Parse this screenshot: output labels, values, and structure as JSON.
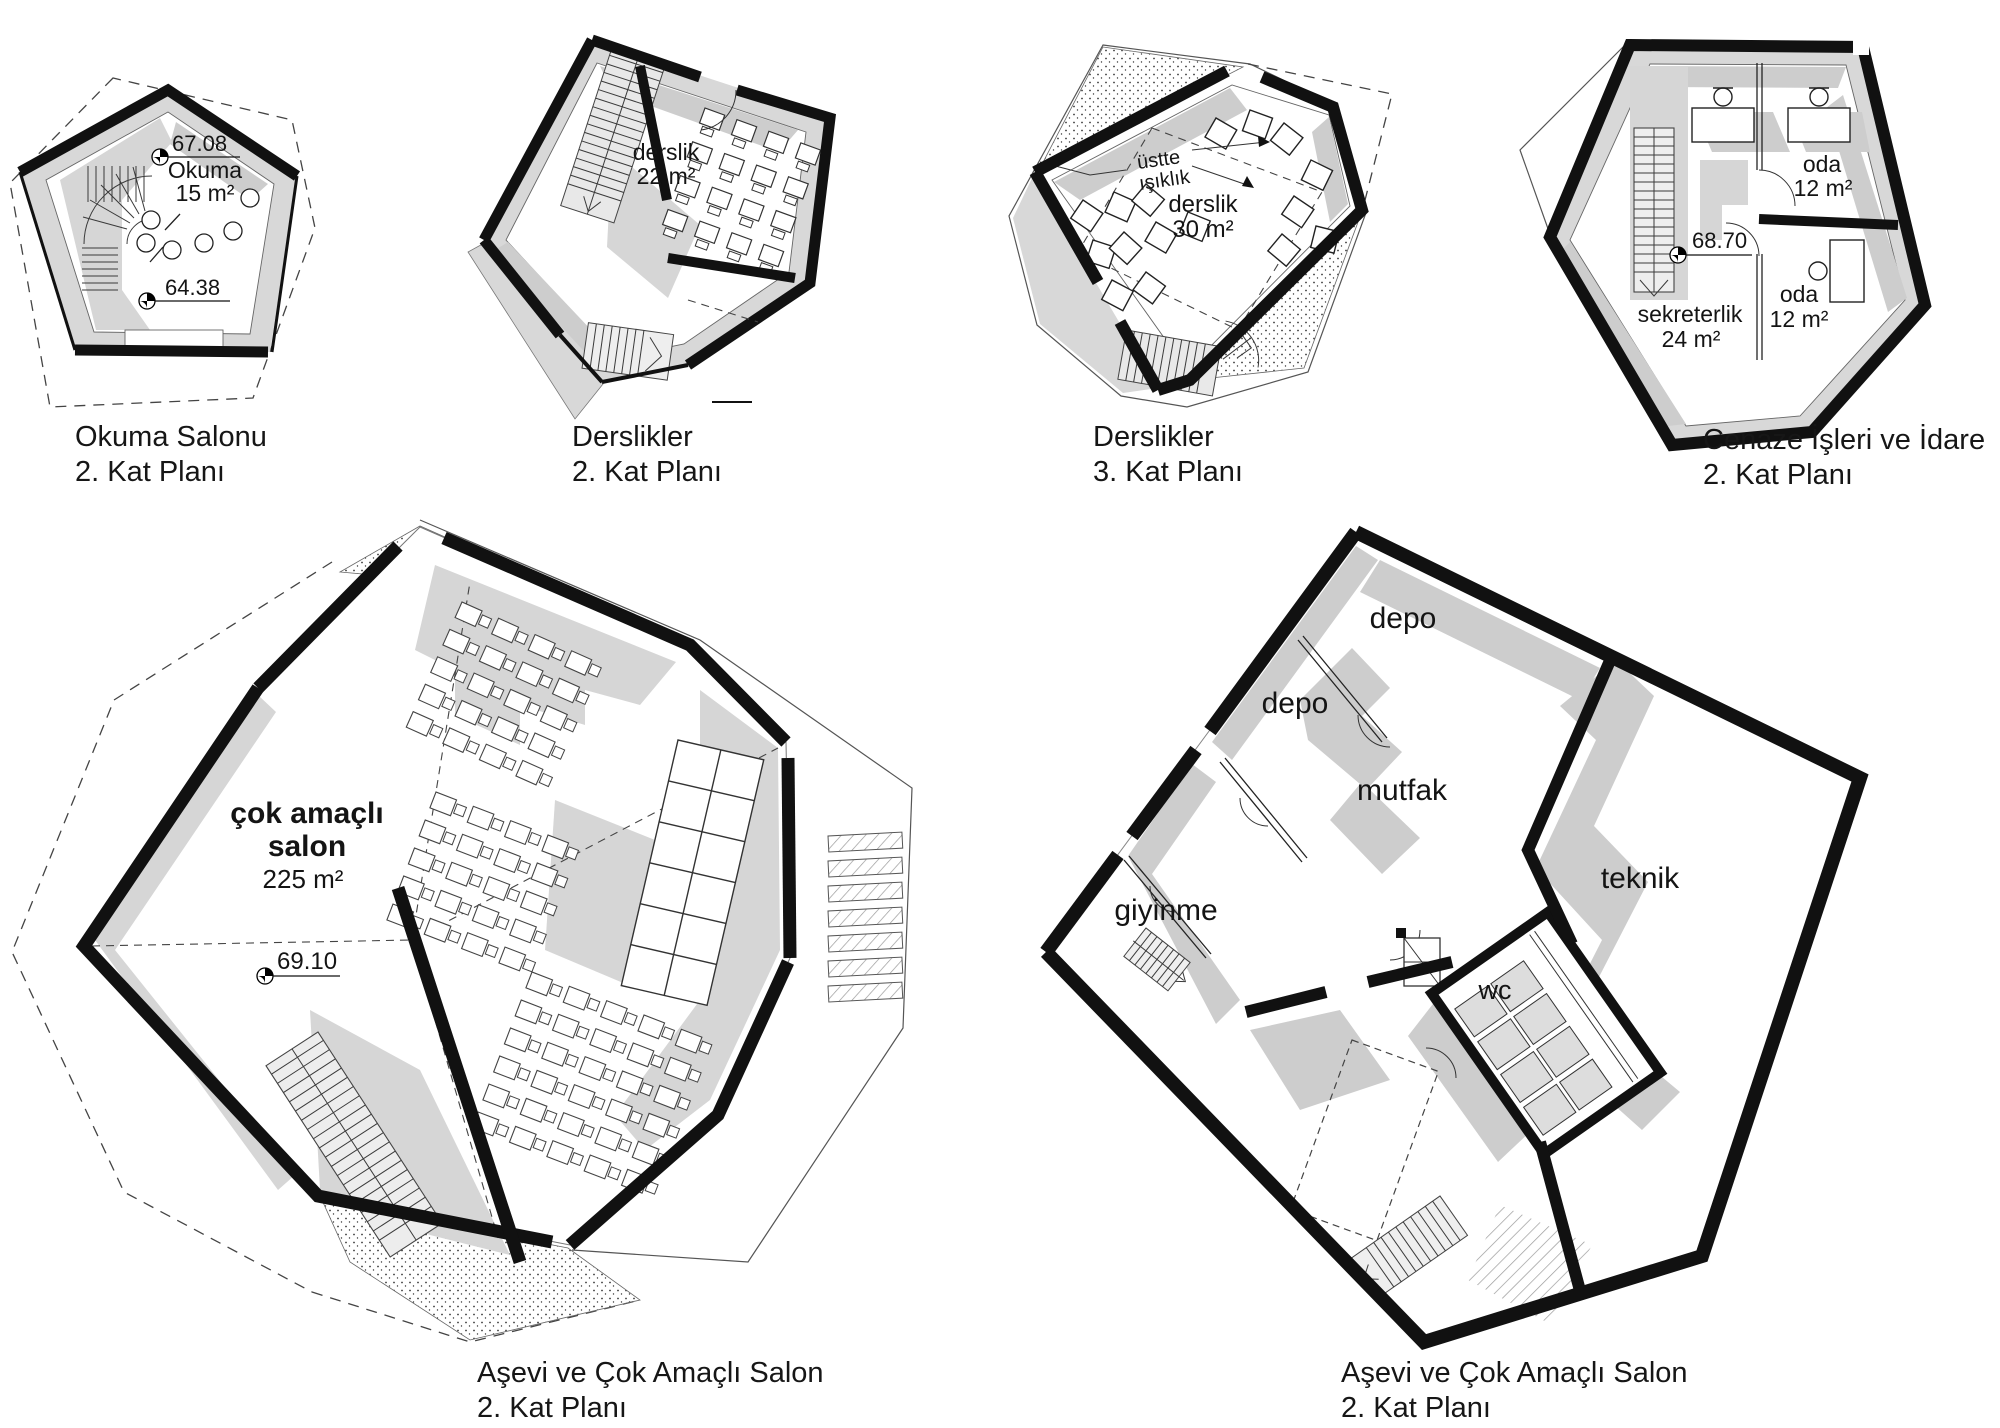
{
  "sheet": {
    "background": "#ffffff",
    "ink": "#111111",
    "poche_gray": "#d8d8d8",
    "shadow_gray": "#cdcdcd"
  },
  "plans": {
    "okuma": {
      "caption": [
        "Okuma Salonu",
        "2. Kat Planı"
      ],
      "labels": {
        "level_upper": "67.08",
        "room_name": "Okuma",
        "room_area": "15 m²",
        "level_lower": "64.38"
      }
    },
    "derslik2": {
      "caption": [
        "Derslikler",
        "2. Kat Planı"
      ],
      "labels": {
        "room_name": "derslik",
        "room_area": "22 m²"
      }
    },
    "derslik3": {
      "caption": [
        "Derslikler",
        "3. Kat Planı"
      ],
      "labels": {
        "skylight_1": "üstte",
        "skylight_2": "ışıklık",
        "room_name": "derslik",
        "room_area": "30 m²"
      }
    },
    "cenaze": {
      "caption": [
        "Cenaze İşleri ve İdare",
        "2. Kat Planı"
      ],
      "labels": {
        "level": "68.70",
        "office_top": "oda",
        "office_top_area": "12 m²",
        "secretary": "sekreterlik",
        "secretary_area": "24 m²",
        "office_bottom": "oda",
        "office_bottom_area": "12 m²"
      }
    },
    "salon": {
      "caption": [
        "Aşevi ve Çok Amaçlı Salon",
        "2. Kat Planı"
      ],
      "labels": {
        "hall_1": "çok amaçlı",
        "hall_2": "salon",
        "hall_area": "225 m²",
        "level": "69.10"
      }
    },
    "servis": {
      "caption": [
        "Aşevi ve Çok Amaçlı Salon",
        "2. Kat Planı"
      ],
      "labels": {
        "storage_top": "depo",
        "storage_mid": "depo",
        "kitchen": "mutfak",
        "technical": "teknik",
        "dressing": "giyinme",
        "wc": "wc"
      }
    }
  }
}
